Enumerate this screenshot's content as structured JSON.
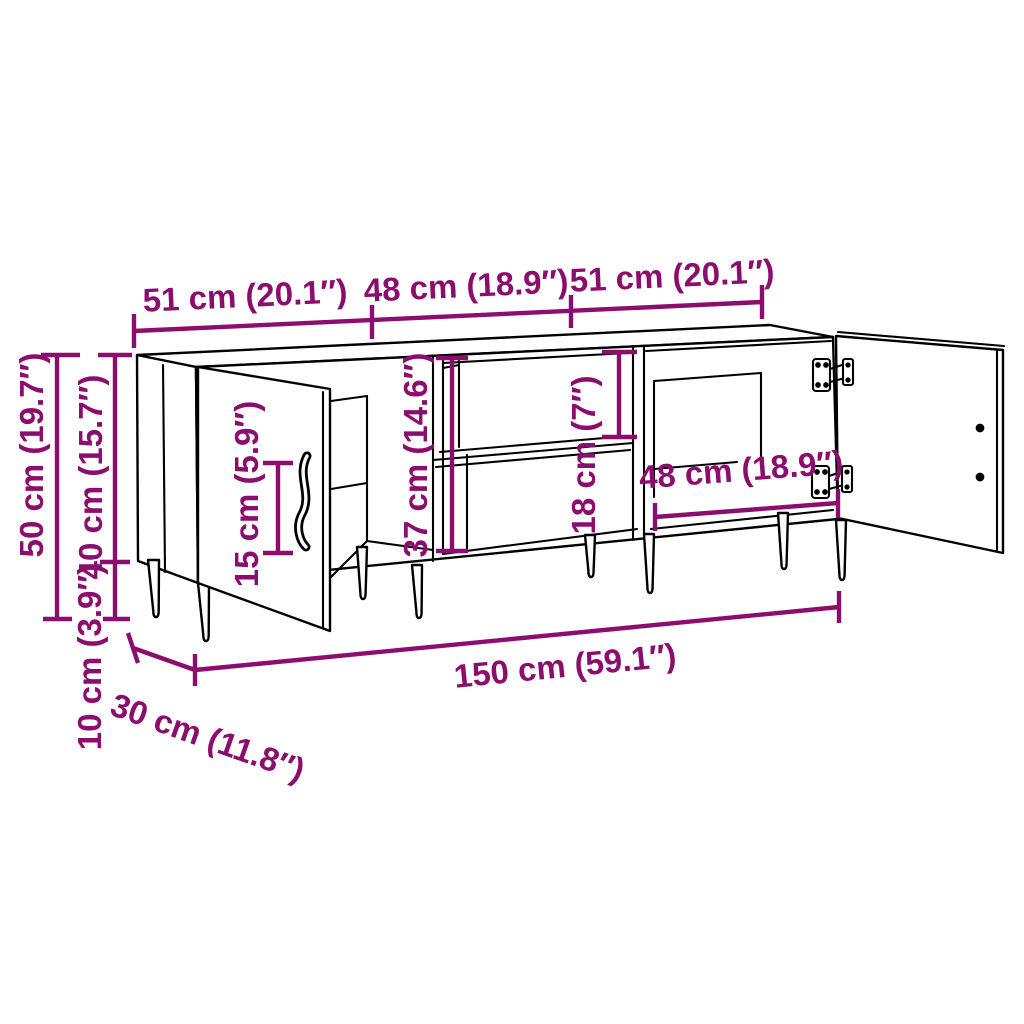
{
  "page": {
    "background": "#FFFFFF"
  },
  "colors": {
    "dimension": "#8B0E6E",
    "outline": "#000000"
  },
  "diagram": {
    "subject": "TV stand line drawing with three sections, two open doors with hinges, middle open shelf compartment and tapered legs",
    "view": "three-quarter perspective dimension diagram"
  },
  "dims": {
    "section_left_width": "51 cm (20.1″)",
    "section_middle_width": "48 cm (18.9″)",
    "section_right_width": "51 cm (20.1″)",
    "overall_height": "50 cm (19.7″)",
    "body_height": "40 cm (15.7″)",
    "leg_height": "10 cm (3.9″)",
    "handle_length": "15 cm (5.9″)",
    "interior_height": "37 cm (14.6″)",
    "shelf_opening_height": "18 cm (7″)",
    "right_compartment_width": "48 cm (18.9″)",
    "overall_width": "150 cm (59.1″)",
    "overall_depth": "30 cm (11.8″)"
  }
}
